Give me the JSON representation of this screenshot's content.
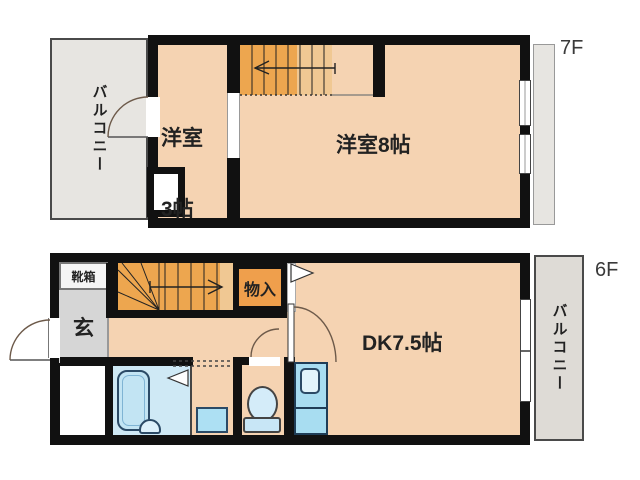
{
  "floors": {
    "upper": {
      "label": "7F",
      "balcony": "バルコニー",
      "room3_line1": "洋室",
      "room3_line2": "3帖",
      "room8": "洋室8帖"
    },
    "lower": {
      "label": "6F",
      "balcony": "バルコニー",
      "shoe_box": "靴箱",
      "entrance": "玄",
      "storage": "物入",
      "dk": "DK7.5帖"
    }
  },
  "colors": {
    "wall": "#111111",
    "room_floor": "#f5d3b2",
    "stairs": "#eda64f",
    "stairs_landing": "#f0c893",
    "storage_fill": "#ef9f4c",
    "balcony_fill": "#e7e5e1",
    "entrance_fill": "#d6d6d6",
    "fixture_blue_light": "#cfe9f5",
    "fixture_blue": "#a8ddf1",
    "fixture_outline": "#2b4a66"
  },
  "icons": {
    "stairs_up_arrow_upper": "arrow-left",
    "stairs_up_arrow_lower": "arrow-right",
    "door_swing": "quarter-arc",
    "closet_door_marker": "triangle-right",
    "bath_door_marker": "triangle-left"
  }
}
